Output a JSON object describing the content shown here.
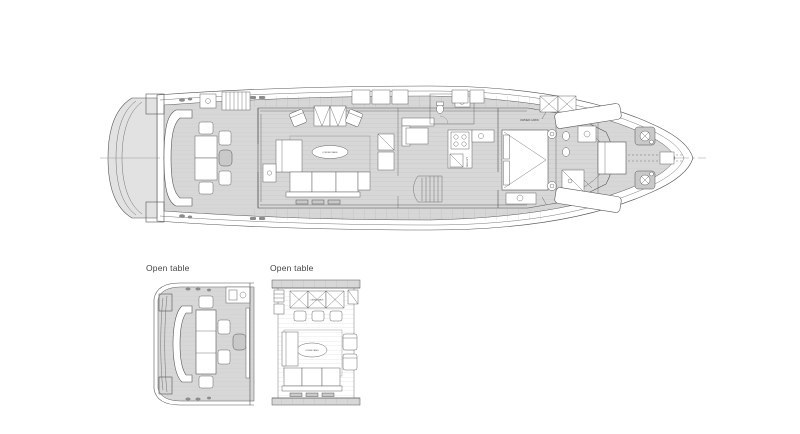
{
  "page": {
    "background": "#ffffff"
  },
  "plan": {
    "type": "yacht-main-deck-plan",
    "captions": {
      "detail1": "Open table",
      "detail2": "Open table"
    },
    "room_labels": {
      "owner_cabin": "OWNER CABIN",
      "galley": "GALLEY",
      "coffee_table": "COFFEE TABLE",
      "dining_table": "DINING TABLE"
    },
    "colors": {
      "line": "#555555",
      "line_light": "#9a9a9a",
      "deck": "#d7d7d7",
      "deck_light": "#e2e2e2",
      "deck_dark": "#c9c9c9",
      "hatch": "#8c8c8c",
      "text": "#444444"
    }
  }
}
